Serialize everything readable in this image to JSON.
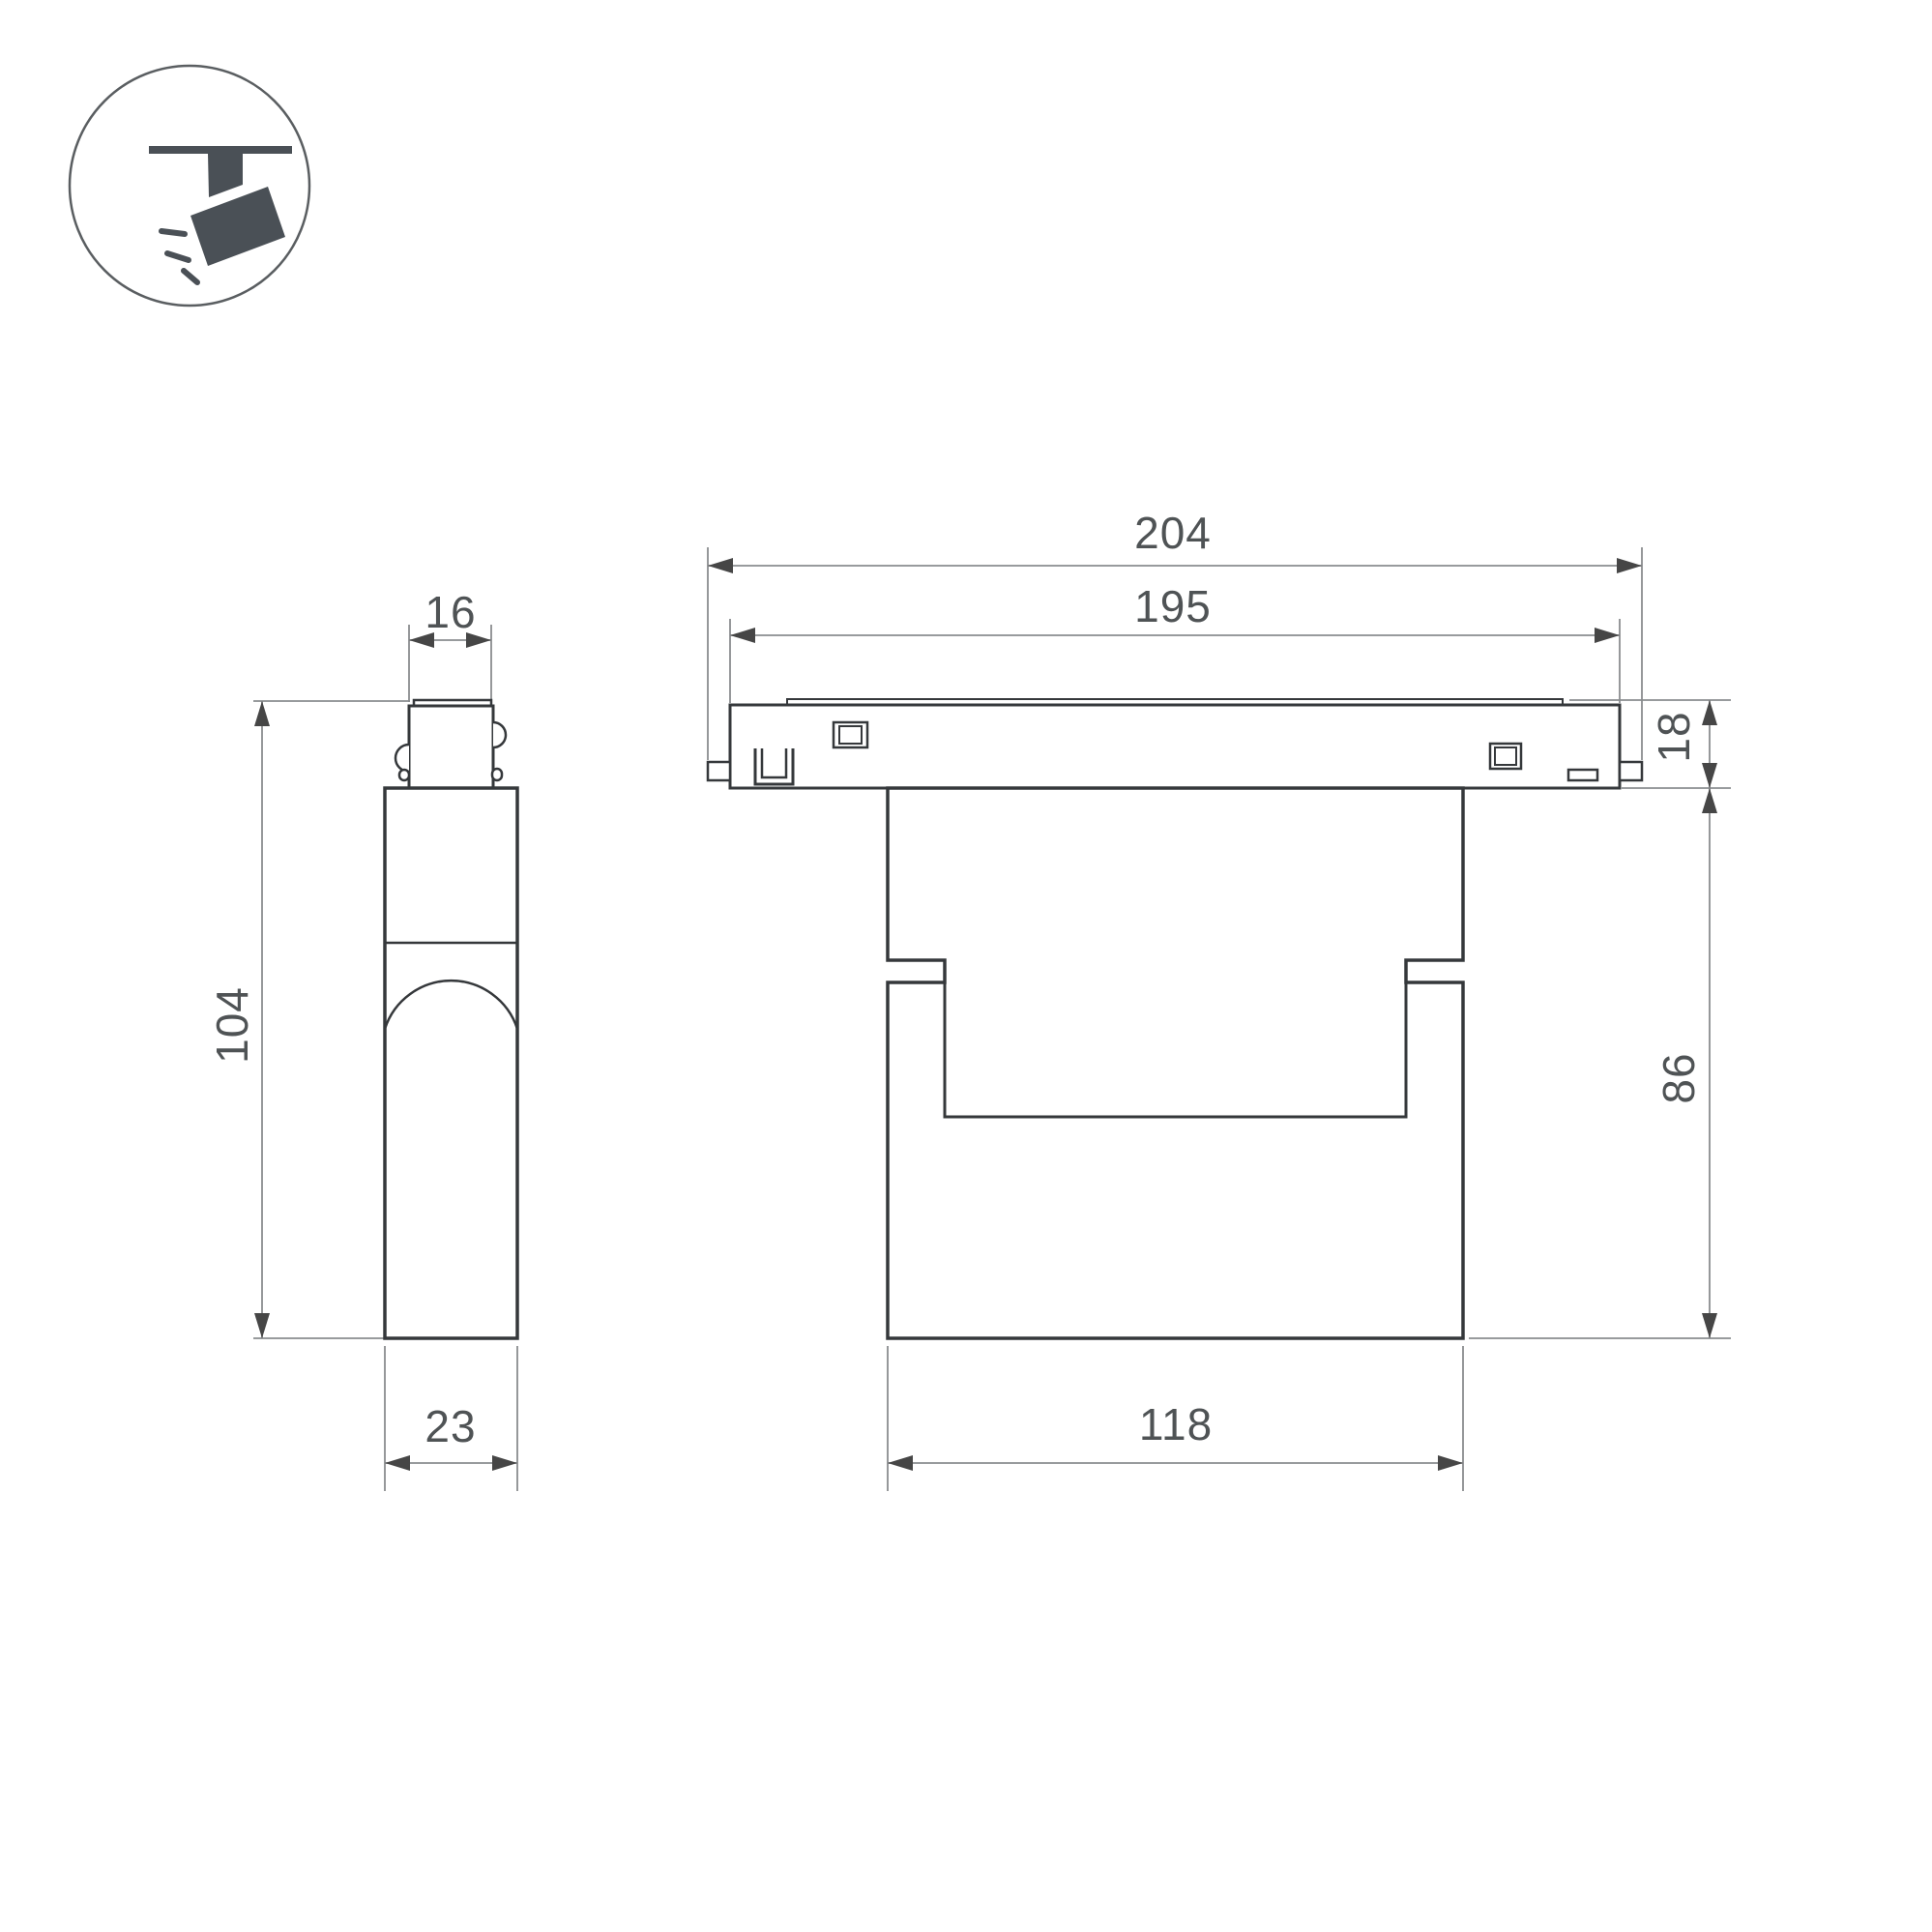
{
  "page": {
    "background": "#ffffff"
  },
  "icon": {
    "name": "track-spotlight-icon",
    "color": "#4a5056",
    "circle_color": "#5a5e61"
  },
  "drawing": {
    "line_color": "#35383b",
    "dim_line_color": "#8a8d8f",
    "arrow_color": "#464646",
    "text_color": "#4f5355",
    "views": {
      "side": {
        "name": "side-view",
        "dimensions": {
          "connector_width": "16",
          "overall_height": "104",
          "body_depth": "23"
        }
      },
      "front": {
        "name": "front-view",
        "dimensions": {
          "overall_length": "204",
          "track_length": "195",
          "track_height": "18",
          "body_height": "86",
          "lamp_width": "118"
        }
      }
    }
  }
}
